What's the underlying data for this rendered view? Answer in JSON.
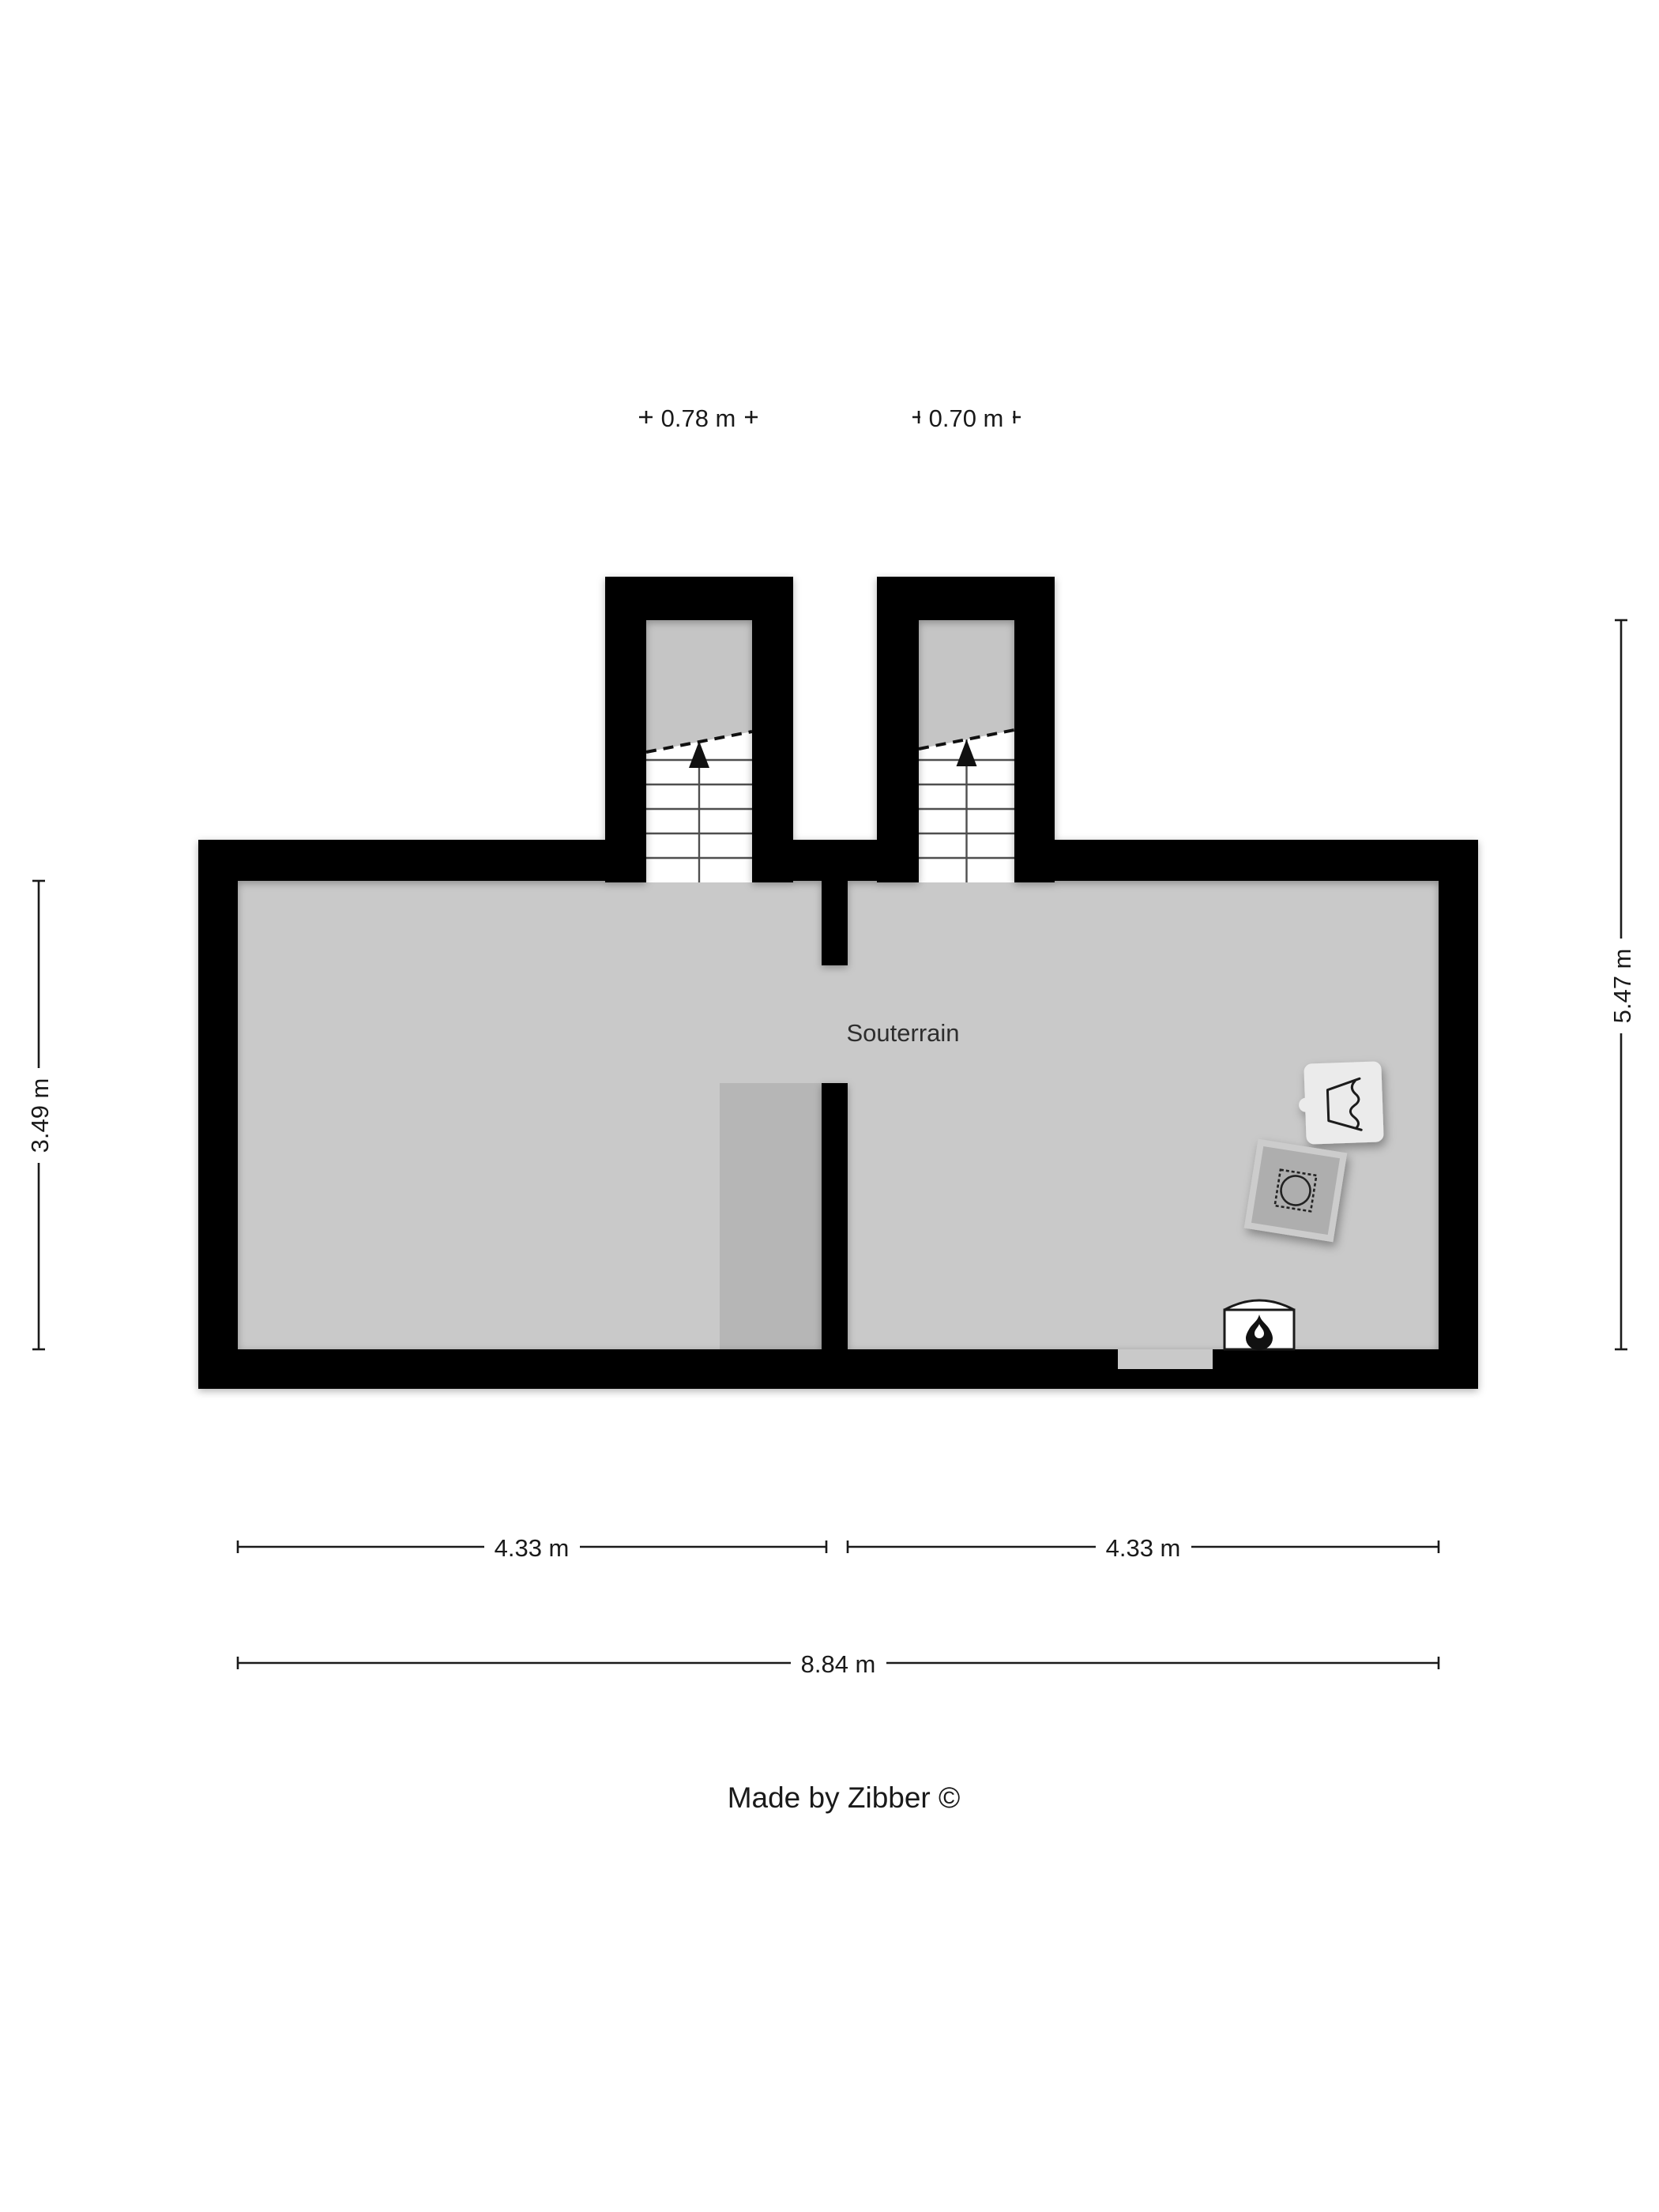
{
  "plan": {
    "room_label": "Souterrain",
    "credit": "Made by Zibber ©"
  },
  "dimensions": {
    "stair_left_width": "0.78 m",
    "stair_right_width": "0.70 m",
    "left_height": "3.49 m",
    "right_height": "5.47 m",
    "room_left_width": "4.33 m",
    "room_right_width": "4.33 m",
    "total_width": "8.84 m"
  },
  "icons": {
    "stair_up_arrow": "up-arrow",
    "washing_machine": "washing-machine",
    "water_heater": "water-heater",
    "fireplace": "flame"
  },
  "colors": {
    "wall": "#000000",
    "floor": "#c9c9c9",
    "stair_upper": "#c5c5c5",
    "inner_block": "#b6b6b6",
    "washer_body": "#aeaeae",
    "washer_frame": "#cccccc",
    "appliance_light": "#ebebeb",
    "stair_white": "#ffffff",
    "dimension": "#1a1a1a"
  }
}
